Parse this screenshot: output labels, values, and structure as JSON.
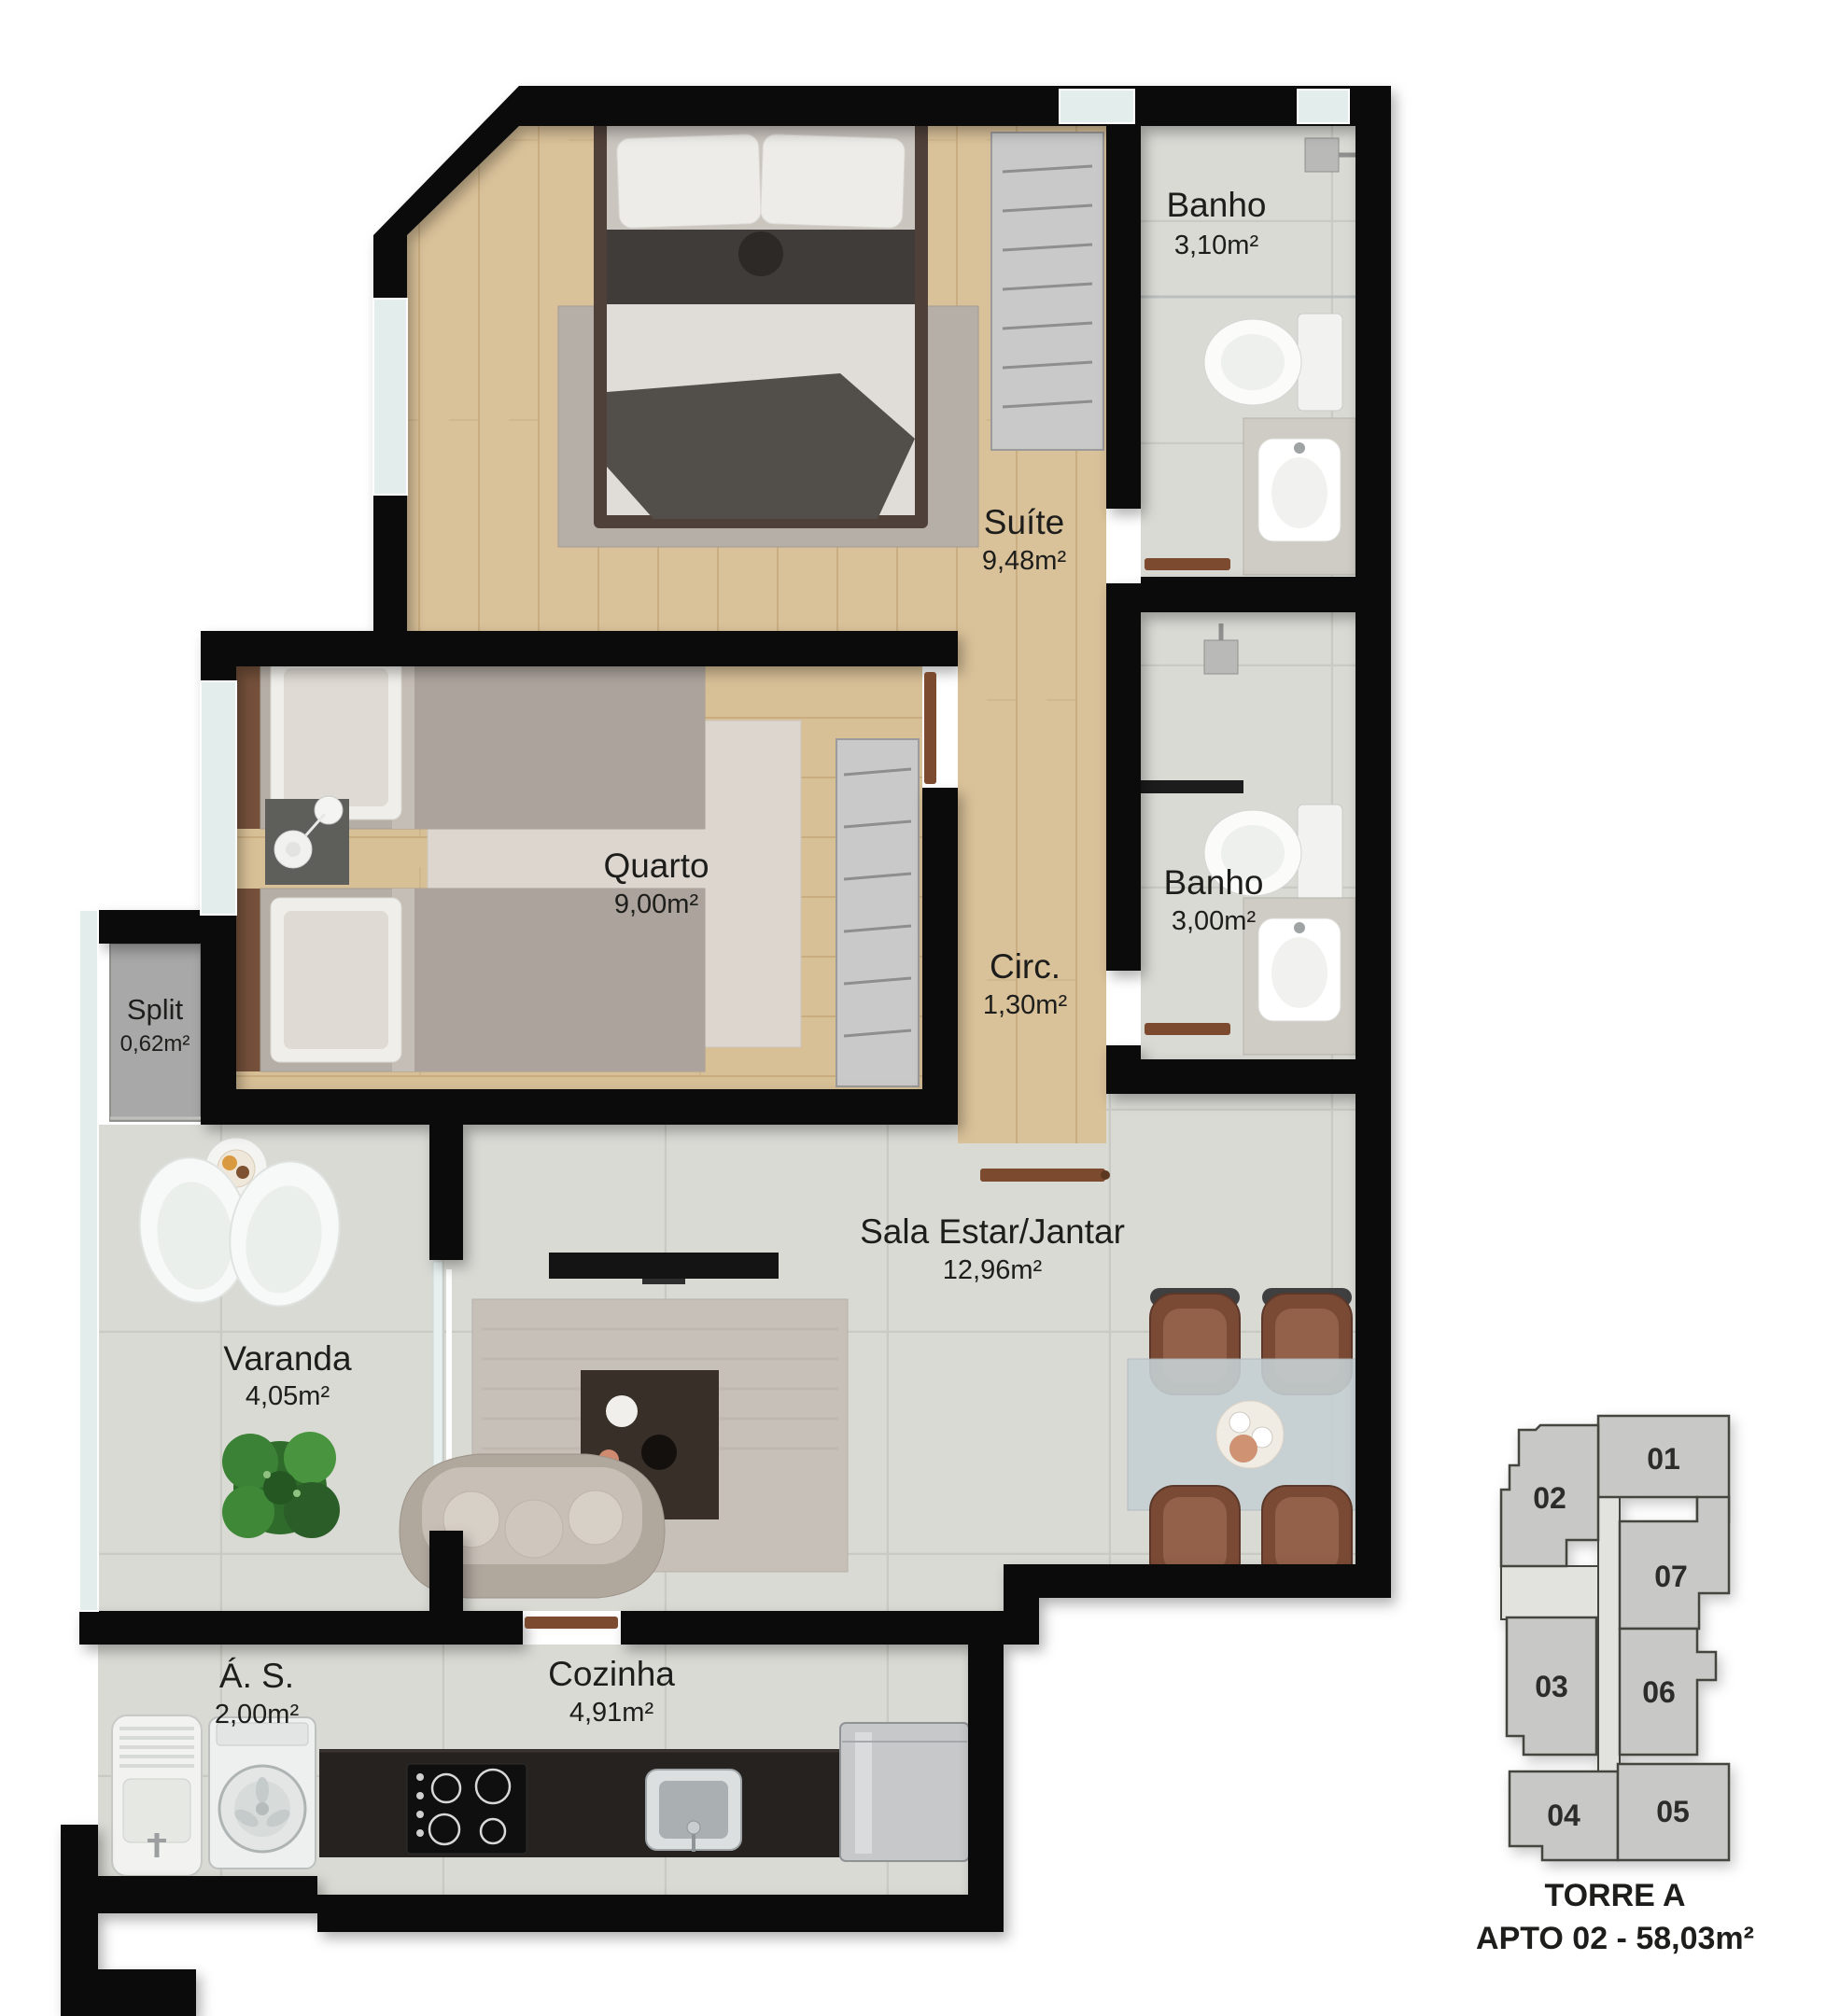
{
  "rooms": {
    "banho1": {
      "name": "Banho",
      "area": "3,10m²"
    },
    "suite": {
      "name": "Suíte",
      "area": "9,48m²"
    },
    "quarto": {
      "name": "Quarto",
      "area": "9,00m²"
    },
    "circ": {
      "name": "Circ.",
      "area": "1,30m²"
    },
    "banho2": {
      "name": "Banho",
      "area": "3,00m²"
    },
    "split": {
      "name": "Split",
      "area": "0,62m²"
    },
    "varanda": {
      "name": "Varanda",
      "area": "4,05m²"
    },
    "sala": {
      "name": "Sala Estar/Jantar",
      "area": "12,96m²"
    },
    "area_servico": {
      "name": "Á. S.",
      "area": "2,00m²"
    },
    "cozinha": {
      "name": "Cozinha",
      "area": "4,91m²"
    }
  },
  "keyplan": {
    "tower": "TORRE A",
    "apartment": "APTO 02 - 58,03m²",
    "highlighted_unit": "02",
    "units": {
      "u01": "01",
      "u02": "02",
      "u03": "03",
      "u04": "04",
      "u05": "05",
      "u06": "06",
      "u07": "07"
    }
  },
  "colors": {
    "wall": "#0b0b0b",
    "wood_floor": "#d9c199",
    "tile_floor": "#dadad5",
    "split_floor": "#a8a8a8",
    "door": "#7c4a2e",
    "unit_fill": "#c8c8c6",
    "unit_highlight": "#ddd3a4",
    "corridor_fill": "#e2e2df",
    "label_text": "#1d1d1b"
  }
}
